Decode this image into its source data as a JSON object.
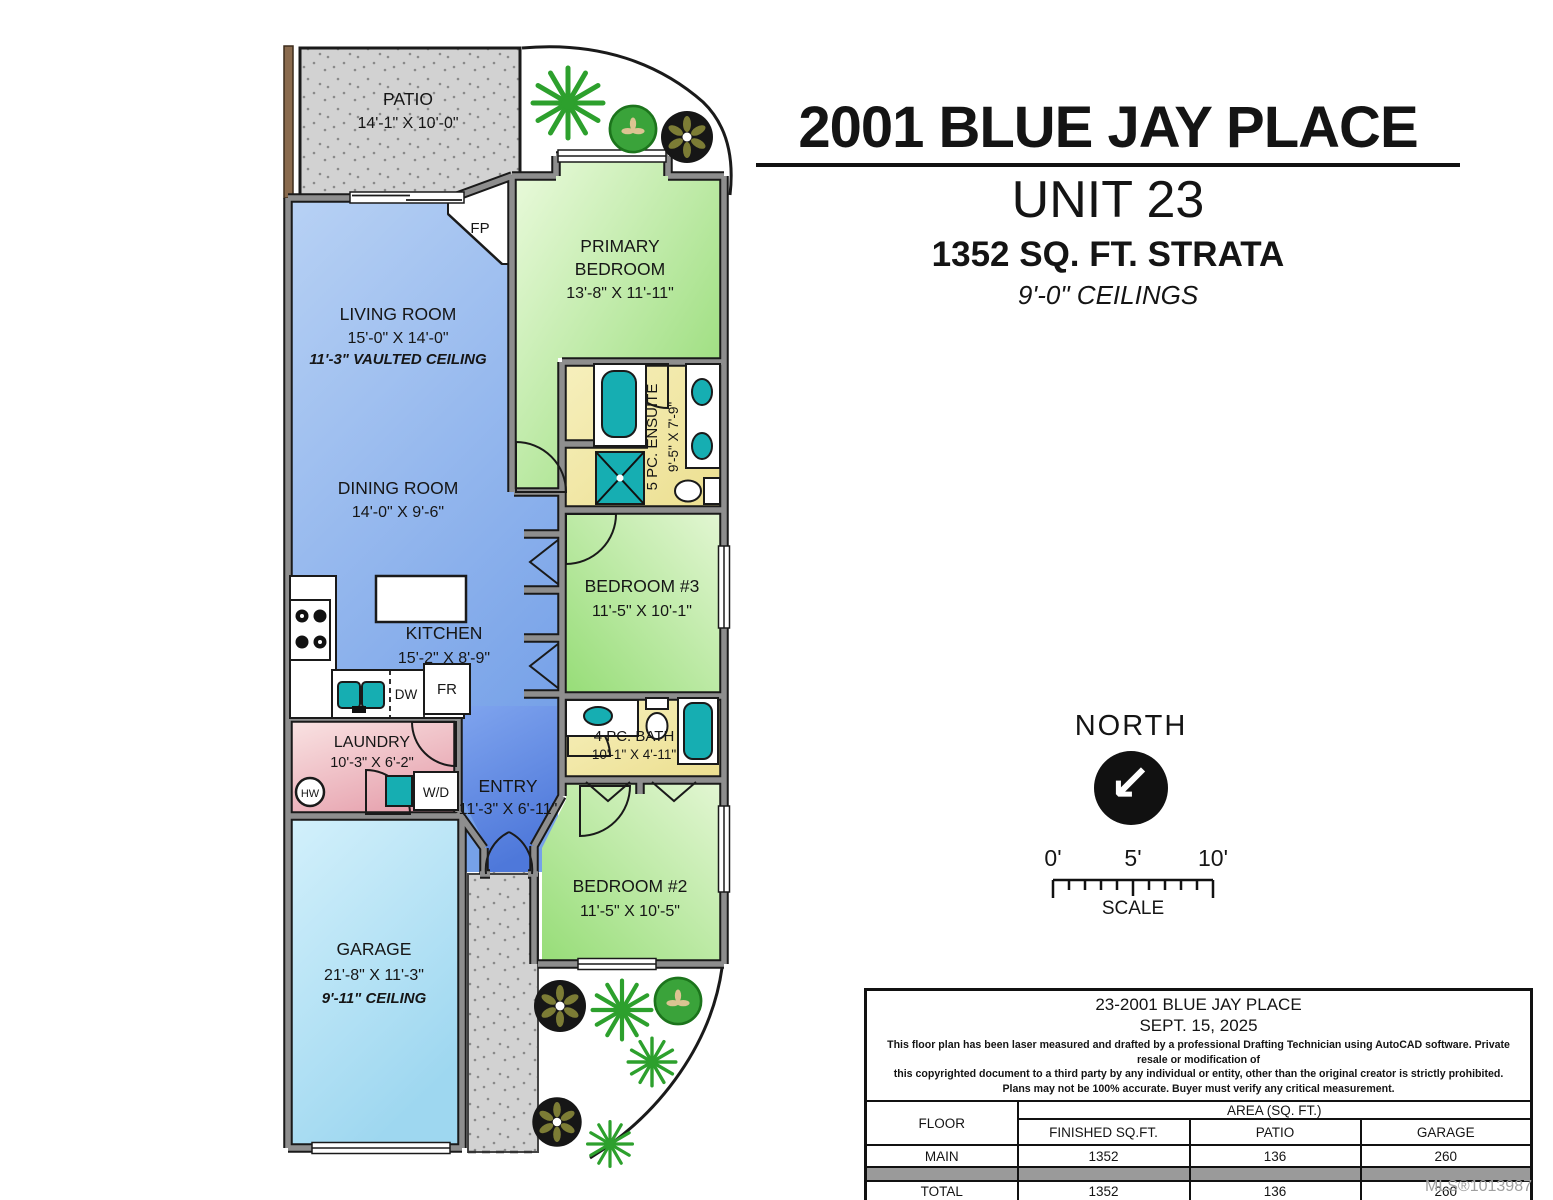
{
  "header": {
    "address": "2001 BLUE JAY PLACE",
    "unit": "UNIT 23",
    "sqft": "1352 SQ. FT. STRATA",
    "ceilings": "9'-0\" CEILINGS"
  },
  "plan": {
    "patio": {
      "name": "PATIO",
      "dims": "14'-1\" X 10'-0\""
    },
    "living": {
      "name": "LIVING ROOM",
      "dims": "15'-0\" X 14'-0\"",
      "note": "11'-3\" VAULTED CEILING"
    },
    "primary": {
      "name1": "PRIMARY",
      "name2": "BEDROOM",
      "dims": "13'-8\" X 11'-11\""
    },
    "ensuite": {
      "name": "5 PC. ENSUITE",
      "dims": "9'-5\" X 7'-9\""
    },
    "dining": {
      "name": "DINING ROOM",
      "dims": "14'-0\" X 9'-6\""
    },
    "kitchen": {
      "name": "KITCHEN",
      "dims": "15'-2\" X 8'-9\""
    },
    "bedroom3": {
      "name": "BEDROOM #3",
      "dims": "11'-5\" X 10'-1\""
    },
    "bath": {
      "name": "4 PC. BATH",
      "dims": "10'-1\" X 4'-11\""
    },
    "laundry": {
      "name": "LAUNDRY",
      "dims": "10'-3\" X 6'-2\""
    },
    "entry": {
      "name": "ENTRY",
      "dims": "11'-3\" X 6'-11\""
    },
    "bedroom2": {
      "name": "BEDROOM #2",
      "dims": "11'-5\" X 10'-5\""
    },
    "garage": {
      "name": "GARAGE",
      "dims": "21'-8\" X 11'-3\"",
      "note": "9'-11\" CEILING"
    },
    "tags": {
      "fp": "FP",
      "dw": "DW",
      "fr": "FR",
      "hw": "HW",
      "wd": "W/D"
    }
  },
  "north": {
    "label": "NORTH",
    "arrow": "↙"
  },
  "scalebar": {
    "t0": "0'",
    "t5": "5'",
    "t10": "10'",
    "label": "SCALE"
  },
  "table": {
    "address": "23-2001 BLUE JAY PLACE",
    "date": "SEPT. 15, 2025",
    "disclaimer1": "This floor plan has been laser measured and drafted by a professional Drafting Technician using AutoCAD software. Private resale or modification of",
    "disclaimer2": "this copyrighted document to a third party by any individual or entity, other than the original creator is strictly prohibited.",
    "disclaimer3": "Plans may not be 100% accurate.  Buyer must verify any critical measurement.",
    "floor_header": "FLOOR",
    "area_header": "AREA (SQ. FT.)",
    "cols": {
      "finished": "FINISHED SQ.FT.",
      "patio": "PATIO",
      "garage": "GARAGE"
    },
    "rows": [
      {
        "floor": "MAIN",
        "finished": "1352",
        "patio": "136",
        "garage": "260"
      },
      {
        "floor": "TOTAL",
        "finished": "1352",
        "patio": "136",
        "garage": "260"
      }
    ]
  },
  "mls": "MLS®1013987",
  "colors": {
    "room_blue": "#9ec0f0",
    "room_blue_dark": "#5e8ae4",
    "room_green": "#a9e48b",
    "room_yellow": "#f2e9a6",
    "room_pink": "#eec0c6",
    "room_cyan": "#bfe7f7",
    "fixture_teal": "#16aeb2",
    "wall_gray": "#8e8e8e",
    "surface_gray": "#d2d2d2"
  }
}
